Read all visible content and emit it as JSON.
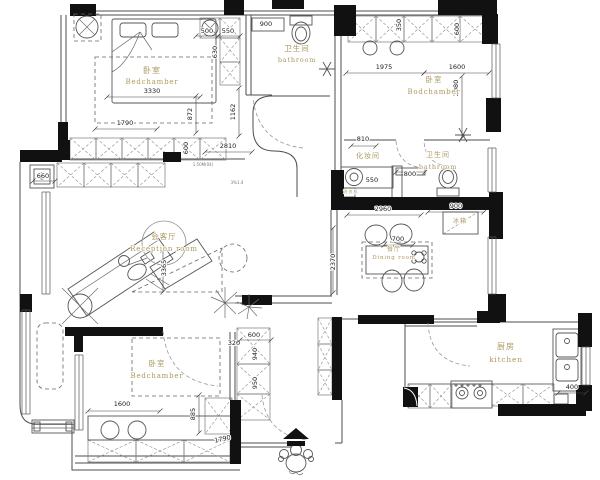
{
  "colors": {
    "wall": "#111111",
    "line": "#555555",
    "room_label": "#ab9a5f",
    "dim_text": "#1a1a1a",
    "background": "#ffffff"
  },
  "rooms": [
    {
      "name": "bedroom-top-left",
      "zh": "卧室",
      "en": "Bedchamber",
      "zx": 152,
      "zy": 73,
      "ex": 152,
      "ey": 84,
      "zs": 8,
      "es": 7
    },
    {
      "name": "bathroom-top",
      "zh": "卫生间",
      "en": "bathroom",
      "zx": 297,
      "zy": 51,
      "ex": 297,
      "ey": 62,
      "zs": 7.5,
      "es": 6.5
    },
    {
      "name": "bedroom-top-right",
      "zh": "卧室",
      "en": "Bodchamber",
      "zx": 434,
      "zy": 82,
      "ex": 434,
      "ey": 94,
      "zs": 7.5,
      "es": 7
    },
    {
      "name": "dressing-room",
      "zh": "化妆间",
      "en": "",
      "zx": 368,
      "zy": 158,
      "ex": 368,
      "ey": 168,
      "zs": 7,
      "es": 6
    },
    {
      "name": "bathroom-middle",
      "zh": "卫生间",
      "en": "bathroom",
      "zx": 438,
      "zy": 157,
      "ex": 438,
      "ey": 169,
      "zs": 7,
      "es": 6.5
    },
    {
      "name": "reception-room",
      "zh": "会客厅",
      "en": "Reception room",
      "zx": 164,
      "zy": 239,
      "ex": 164,
      "ey": 251,
      "zs": 7.5,
      "es": 7
    },
    {
      "name": "dining-room",
      "zh": "餐厅",
      "en": "Dining room",
      "zx": 394,
      "zy": 251,
      "ex": 394,
      "ey": 259,
      "zs": 6,
      "es": 5.5
    },
    {
      "name": "bedroom-bottom-left",
      "zh": "卧室",
      "en": "Bedchamber",
      "zx": 157,
      "zy": 366,
      "ex": 157,
      "ey": 378,
      "zs": 7.5,
      "es": 7
    },
    {
      "name": "kitchen",
      "zh": "厨房",
      "en": "kitchen",
      "zx": 506,
      "zy": 349,
      "ex": 506,
      "ey": 362,
      "zs": 8,
      "es": 7.5
    }
  ],
  "fixture_labels": [
    {
      "name": "fridge-label",
      "text": "冰箱",
      "x": 460,
      "y": 223,
      "size": 6
    },
    {
      "name": "washer-label",
      "text": "洗衣机",
      "x": 351,
      "y": 193,
      "size": 4
    }
  ],
  "annotations": [
    {
      "name": "note-level",
      "text": "1.50M(04)",
      "x": 203,
      "y": 166,
      "size": 4
    },
    {
      "name": "note-slope",
      "text": "3%1.4",
      "x": 237,
      "y": 184,
      "size": 4
    }
  ],
  "dimensions": [
    {
      "name": "dim-3330",
      "text": "3330",
      "x": 152,
      "y": 93,
      "rot": 0,
      "line": [
        107,
        97,
        200,
        97
      ]
    },
    {
      "name": "dim-1790-tl",
      "text": "1790",
      "x": 125,
      "y": 125,
      "rot": 0,
      "line": [
        95,
        129,
        157,
        129
      ]
    },
    {
      "name": "dim-872",
      "text": "872",
      "x": 192,
      "y": 114,
      "rot": -90,
      "line": [
        196,
        96,
        196,
        133
      ]
    },
    {
      "name": "dim-1162",
      "text": "1162",
      "x": 235,
      "y": 112,
      "rot": -90,
      "line": [
        239,
        88,
        239,
        136
      ]
    },
    {
      "name": "dim-500",
      "text": "500",
      "x": 207,
      "y": 33,
      "rot": 0,
      "line": [
        196,
        36,
        218,
        36
      ]
    },
    {
      "name": "dim-550-tl",
      "text": "550",
      "x": 228,
      "y": 33,
      "rot": 0,
      "line": [
        218,
        36,
        240,
        36
      ]
    },
    {
      "name": "dim-630",
      "text": "630",
      "x": 217,
      "y": 52,
      "rot": -90
    },
    {
      "name": "dim-900-top",
      "text": "900",
      "x": 266,
      "y": 26,
      "rot": 0
    },
    {
      "name": "dim-2810",
      "text": "2810",
      "x": 228,
      "y": 148,
      "rot": 0,
      "line": [
        205,
        152,
        252,
        152
      ]
    },
    {
      "name": "dim-600-tl",
      "text": "600",
      "x": 188,
      "y": 148,
      "rot": -90
    },
    {
      "name": "dim-660",
      "text": "660",
      "x": 43,
      "y": 178,
      "rot": 0,
      "line": [
        33,
        181,
        55,
        181
      ]
    },
    {
      "name": "dim-3365",
      "text": "3365",
      "x": 166,
      "y": 268,
      "rot": -90,
      "line": [
        163,
        250,
        163,
        292
      ]
    },
    {
      "name": "dim-1975",
      "text": "1975",
      "x": 384,
      "y": 69,
      "rot": 0,
      "line": [
        346,
        73,
        424,
        73
      ]
    },
    {
      "name": "dim-1600-tr",
      "text": "1600",
      "x": 457,
      "y": 69,
      "rot": 0,
      "line": [
        424,
        73,
        489,
        73
      ]
    },
    {
      "name": "dim-2080",
      "text": "2080",
      "x": 458,
      "y": 88,
      "rot": -90,
      "line": [
        462,
        76,
        462,
        138
      ]
    },
    {
      "name": "dim-600-tr",
      "text": "600",
      "x": 459,
      "y": 29,
      "rot": -90
    },
    {
      "name": "dim-350",
      "text": "350",
      "x": 401,
      "y": 25,
      "rot": -90
    },
    {
      "name": "dim-810",
      "text": "810",
      "x": 363,
      "y": 141,
      "rot": 0,
      "line": [
        351,
        146,
        376,
        146
      ]
    },
    {
      "name": "dim-550-mid",
      "text": "550",
      "x": 372,
      "y": 182,
      "rot": 0
    },
    {
      "name": "dim-800",
      "text": "800",
      "x": 410,
      "y": 176,
      "rot": 0,
      "line": [
        396,
        172,
        425,
        172
      ]
    },
    {
      "name": "dim-2960",
      "text": "2960",
      "x": 383,
      "y": 211,
      "rot": 0,
      "line": [
        347,
        215,
        421,
        215
      ]
    },
    {
      "name": "dim-900-fridge",
      "text": "900",
      "x": 456,
      "y": 208,
      "rot": 0,
      "line": [
        428,
        212,
        484,
        212
      ]
    },
    {
      "name": "dim-700",
      "text": "700",
      "x": 398,
      "y": 241,
      "rot": 0,
      "line": [
        384,
        245,
        413,
        245
      ]
    },
    {
      "name": "dim-2370",
      "text": "2370",
      "x": 335,
      "y": 262,
      "rot": -90,
      "line": [
        333,
        228,
        333,
        293
      ]
    },
    {
      "name": "dim-320",
      "text": "320",
      "x": 234,
      "y": 345,
      "rot": 0
    },
    {
      "name": "dim-600-entry",
      "text": "600",
      "x": 254,
      "y": 337,
      "rot": 0,
      "line": [
        240,
        340,
        271,
        340
      ]
    },
    {
      "name": "dim-940",
      "text": "940",
      "x": 257,
      "y": 354,
      "rot": -90
    },
    {
      "name": "dim-950",
      "text": "950",
      "x": 257,
      "y": 383,
      "rot": -90
    },
    {
      "name": "dim-1600-bl",
      "text": "1600",
      "x": 122,
      "y": 406,
      "rot": 0,
      "line": [
        88,
        411,
        160,
        411
      ]
    },
    {
      "name": "dim-885",
      "text": "885",
      "x": 195,
      "y": 414,
      "rot": -90,
      "line": [
        199,
        395,
        199,
        433
      ]
    },
    {
      "name": "dim-1790-bl",
      "text": "1790",
      "x": 223,
      "y": 441,
      "rot": -12
    },
    {
      "name": "dim-400",
      "text": "400",
      "x": 572,
      "y": 389,
      "rot": 0,
      "line": [
        558,
        393,
        586,
        393
      ]
    }
  ]
}
